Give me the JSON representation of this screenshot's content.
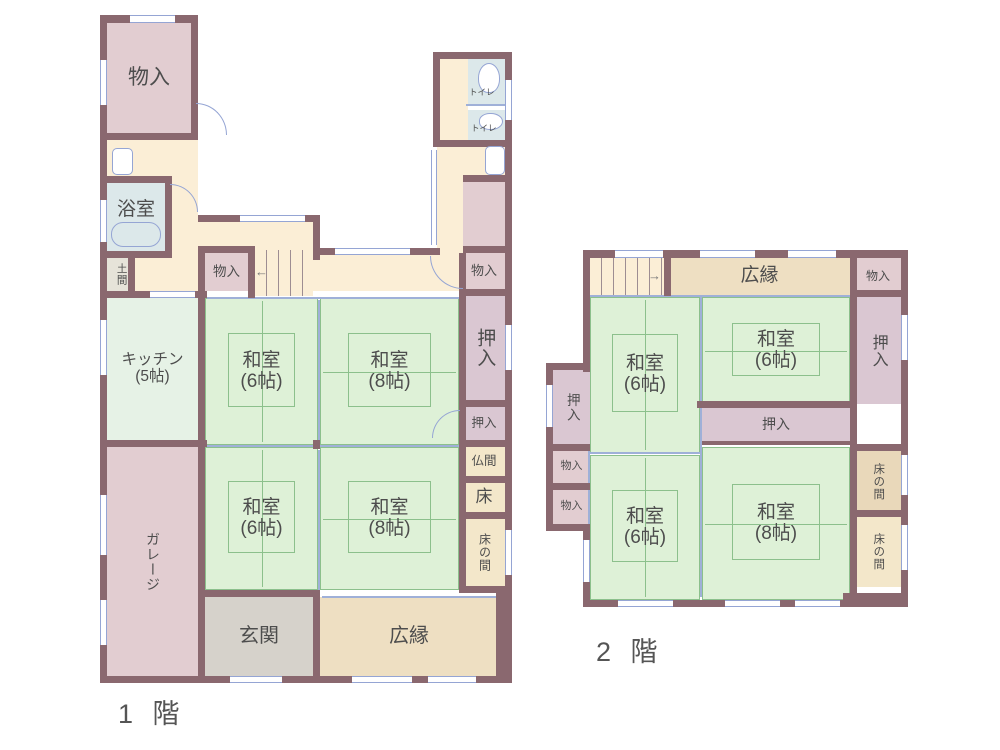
{
  "palette": {
    "wall": "#8a686f",
    "hallway": "#fbeed6",
    "storage_pink": "#e2cdd1",
    "closet_mauve": "#dac7d2",
    "tatami_green": "#def1d7",
    "tatami_line": "#8cc08c",
    "kitchen_green": "#e6f2e6",
    "veranda_tan": "#eedfc2",
    "alcove_cream": "#f3e7ca",
    "bath_blue": "#dce8ea",
    "entrance_gray": "#d6d2cb",
    "opening_blue": "#95a5d4",
    "text": "#4d4d4d"
  },
  "floor1": {
    "caption": "1 階",
    "rooms": {
      "storage_tl": {
        "label": "物入"
      },
      "toilet_upper": {
        "label": "トイレ"
      },
      "toilet_lower": {
        "label": "トイレ"
      },
      "bathroom": {
        "label": "浴室"
      },
      "doma": {
        "label": "土間"
      },
      "storage_mid": {
        "label": "物入"
      },
      "storage_right": {
        "label": "物入"
      },
      "kitchen": {
        "label": "キッチン",
        "size": "(5帖)"
      },
      "washitsu_nw": {
        "label": "和室",
        "size": "(6帖)"
      },
      "washitsu_ne": {
        "label": "和室",
        "size": "(8帖)"
      },
      "washitsu_sw": {
        "label": "和室",
        "size": "(6帖)"
      },
      "washitsu_se": {
        "label": "和室",
        "size": "(8帖)"
      },
      "oshiire_tall": {
        "label": "押入"
      },
      "oshiire_small": {
        "label": "押入"
      },
      "butsuma": {
        "label": "仏間"
      },
      "toko": {
        "label": "床"
      },
      "tokonoma": {
        "label": "床の間"
      },
      "garage": {
        "label": "ガレージ"
      },
      "genkan": {
        "label": "玄関"
      },
      "hiroen": {
        "label": "広縁"
      }
    }
  },
  "floor2": {
    "caption": "2 階",
    "rooms": {
      "hiroen": {
        "label": "広縁"
      },
      "storage_top": {
        "label": "物入"
      },
      "washitsu_nw": {
        "label": "和室",
        "size": "(6帖)"
      },
      "washitsu_ne": {
        "label": "和室",
        "size": "(6帖)"
      },
      "oshiire_right": {
        "label": "押入"
      },
      "oshiire_mid": {
        "label": "押入"
      },
      "oshiire_left": {
        "label": "押入"
      },
      "storage_l1": {
        "label": "物入"
      },
      "storage_l2": {
        "label": "物入"
      },
      "washitsu_sw": {
        "label": "和室",
        "size": "(6帖)"
      },
      "washitsu_se": {
        "label": "和室",
        "size": "(8帖)"
      },
      "tokonoma_upper": {
        "label": "床の間"
      },
      "tokonoma_lower": {
        "label": "床の間"
      }
    }
  }
}
